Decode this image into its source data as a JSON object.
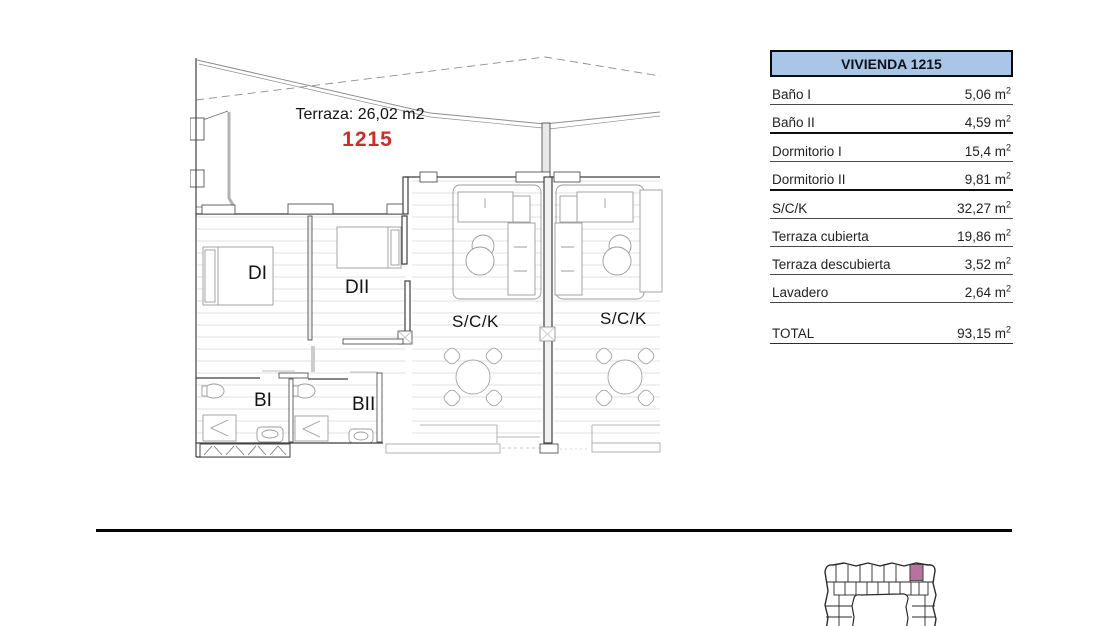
{
  "colors": {
    "unit_number_red": "#d22a26",
    "table_header_bg": "#a9c6e6",
    "keyplan_highlight": "#b5739e"
  },
  "plan": {
    "terrace_label": "Terraza: 26,02 m2",
    "unit_number": "1215",
    "rooms": {
      "dormitorio1": "DI",
      "dormitorio2": "DII",
      "salon_left": "S/C/K",
      "salon_right": "S/C/K",
      "bano1": "BI",
      "bano2": "BII"
    }
  },
  "table": {
    "title": "VIVIENDA 1215",
    "rows": [
      {
        "label": "Baño I",
        "value": "5,06",
        "unit": "m",
        "sup": "2"
      },
      {
        "label": "Baño II",
        "value": "4,59",
        "unit": "m",
        "sup": "2"
      },
      {
        "label": "Dormitorio I",
        "value": "15,4",
        "unit": "m",
        "sup": "2"
      },
      {
        "label": "Dormitorio II",
        "value": "9,81",
        "unit": "m",
        "sup": "2"
      },
      {
        "label": "S/C/K",
        "value": "32,27",
        "unit": "m",
        "sup": "2"
      },
      {
        "label": "Terraza cubierta",
        "value": "19,86",
        "unit": "m",
        "sup": "2"
      },
      {
        "label": "Terraza descubierta",
        "value": "3,52",
        "unit": "m",
        "sup": "2"
      },
      {
        "label": "Lavadero",
        "value": "2,64",
        "unit": "m",
        "sup": "2"
      }
    ],
    "total": {
      "label": "TOTAL",
      "value": "93,15",
      "unit": "m",
      "sup": "2"
    }
  }
}
